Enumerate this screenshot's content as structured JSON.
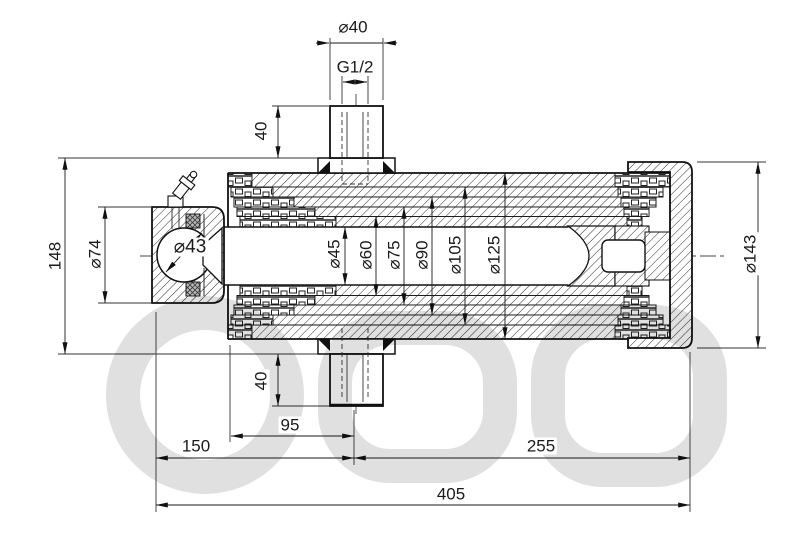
{
  "drawing": {
    "subject": "telescopic-hydraulic-cylinder-cross-section",
    "dims": {
      "port_diameter": "⌀40",
      "port_thread": "G1/2",
      "port_height_top": "40",
      "overall_height": "148",
      "eye_bore": "⌀74",
      "ball_diameter": "⌀43",
      "stage_1": "⌀45",
      "stage_2": "⌀60",
      "stage_3": "⌀75",
      "stage_4": "⌀90",
      "stage_5": "⌀105",
      "stage_6": "⌀125",
      "cap_diameter": "⌀143",
      "port_height_bottom": "40",
      "port_offset": "95",
      "mount_length": "150",
      "barrel_length": "255",
      "overall_length": "405"
    }
  }
}
